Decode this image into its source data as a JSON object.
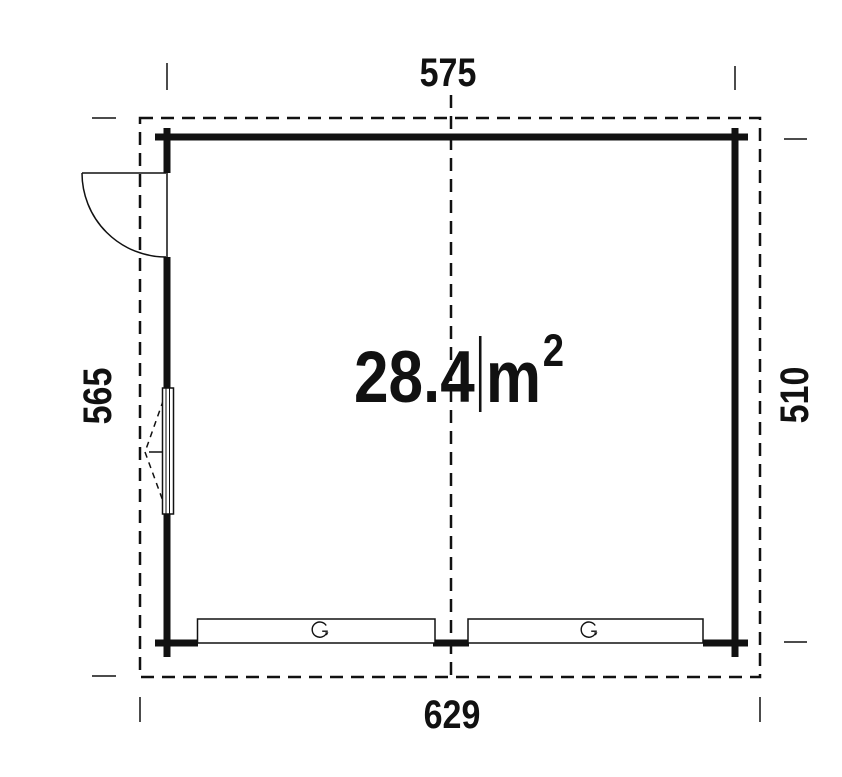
{
  "plan": {
    "area": {
      "value": "28.4",
      "unit": "m",
      "superscript": "2"
    },
    "dimensions": {
      "top": "575",
      "bottom": "629",
      "left": "565",
      "right": "510"
    },
    "colors": {
      "line": "#111111",
      "background": "#ffffff"
    },
    "icons": {
      "garage_door_rotation": "counterclockwise-open-circle-arrow (G-shaped up-and-over door symbol)",
      "door_swing": "quarter-circle door swing arc",
      "window_tilt": "dashed V opening-direction indicator"
    }
  }
}
